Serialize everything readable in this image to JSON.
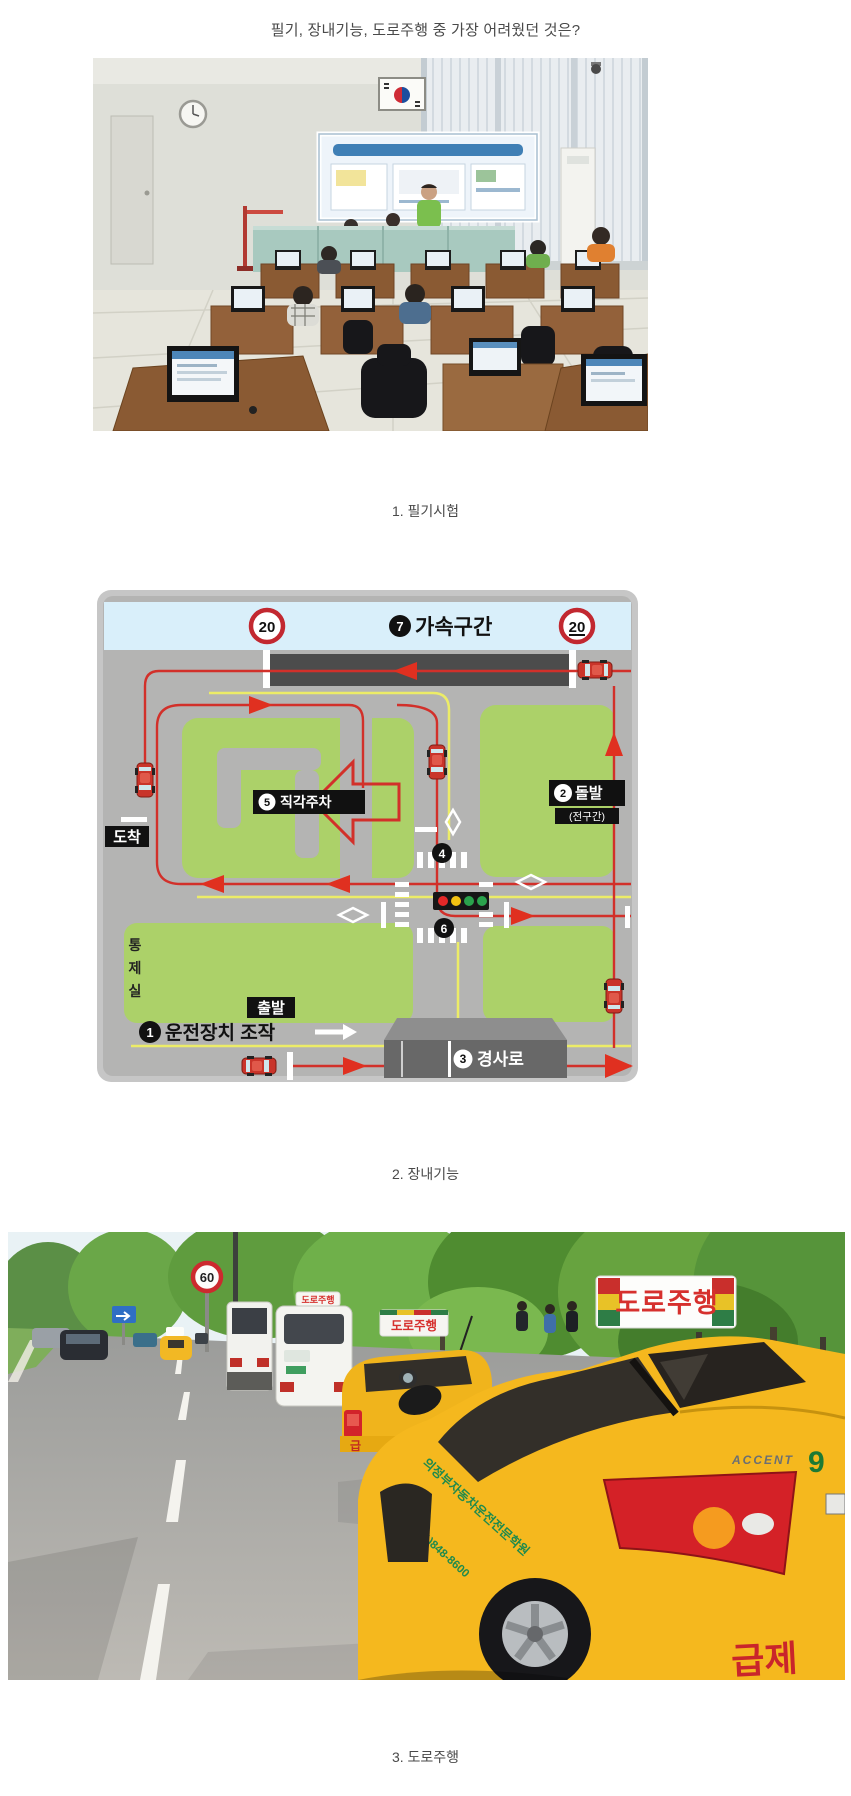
{
  "page": {
    "title": "필기, 장내기능, 도로주행 중 가장 어려웠던 것은?"
  },
  "captions": {
    "c1": "1. 필기시험",
    "c2": "2. 장내기능",
    "c3": "3. 도로주행"
  },
  "course": {
    "speed_limit": "20",
    "s7_num": "7",
    "s7": "가속구간",
    "s2_num": "2",
    "s2": "돌발",
    "s2_sub": "(전구간)",
    "s5_num": "5",
    "s5": "직각주차",
    "s4_num": "4",
    "s6_num": "6",
    "s1_num": "1",
    "s1": "운전장치 조작",
    "s3_num": "3",
    "s3": "경사로",
    "start": "출발",
    "finish": "도착",
    "control": {
      "c1": "통",
      "c2": "제",
      "c3": "실"
    }
  },
  "road": {
    "speed_limit": "60",
    "roof_sign": "도로주행",
    "roof_sign_mid": "도로주행",
    "roof_sign_van": "도로주행",
    "school_name": "의정부자동차운전전문학원",
    "phone": "031)848-8600",
    "badge": "ACCENT",
    "badge_num": "9",
    "bumper_text": "급제",
    "mid_bumper_text": "급",
    "mid_number": "8"
  },
  "colors": {
    "accent_red": "#d2302a",
    "course_green": "#acd169",
    "course_gray": "#b4b4b3",
    "band_blue": "#d9effa",
    "taxi_yellow": "#f5b81e",
    "school_text_green": "#1f8a4d"
  }
}
